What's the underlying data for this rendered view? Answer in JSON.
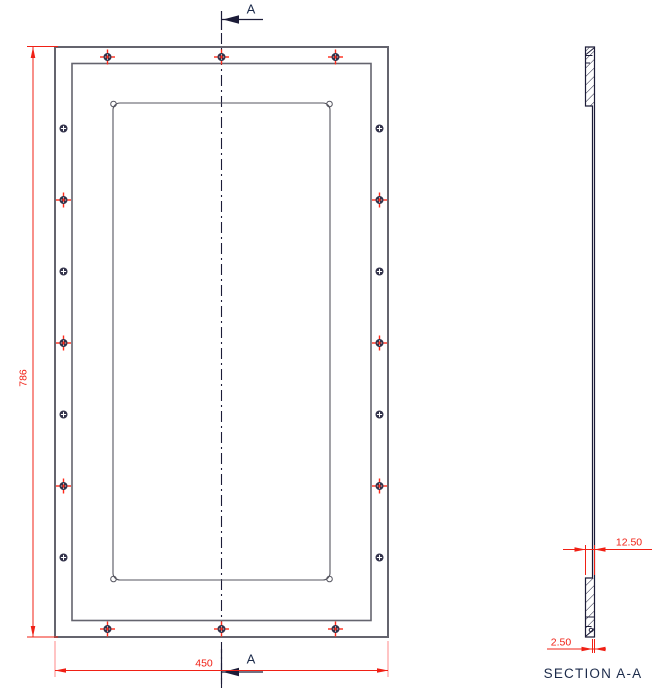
{
  "drawing": {
    "front_view": {
      "section_label_top": "A",
      "section_label_bottom": "A",
      "height_dim": "786",
      "width_dim": "450",
      "holes": [
        {
          "x": 107.5,
          "y": 57,
          "type": "cross"
        },
        {
          "x": 221.5,
          "y": 57,
          "type": "cross"
        },
        {
          "x": 335.5,
          "y": 57,
          "type": "cross"
        },
        {
          "x": 107.5,
          "y": 629,
          "type": "cross"
        },
        {
          "x": 221.5,
          "y": 629,
          "type": "cross"
        },
        {
          "x": 335.5,
          "y": 629,
          "type": "cross"
        },
        {
          "x": 63.5,
          "y": 128.5,
          "type": "plain"
        },
        {
          "x": 63.5,
          "y": 200,
          "type": "cross"
        },
        {
          "x": 63.5,
          "y": 271.5,
          "type": "plain"
        },
        {
          "x": 63.5,
          "y": 343,
          "type": "cross"
        },
        {
          "x": 63.5,
          "y": 414.5,
          "type": "plain"
        },
        {
          "x": 63.5,
          "y": 486,
          "type": "cross"
        },
        {
          "x": 63.5,
          "y": 557.5,
          "type": "plain"
        },
        {
          "x": 379.5,
          "y": 128.5,
          "type": "plain"
        },
        {
          "x": 379.5,
          "y": 200,
          "type": "cross"
        },
        {
          "x": 379.5,
          "y": 271.5,
          "type": "plain"
        },
        {
          "x": 379.5,
          "y": 343,
          "type": "cross"
        },
        {
          "x": 379.5,
          "y": 414.5,
          "type": "plain"
        },
        {
          "x": 379.5,
          "y": 486,
          "type": "cross"
        },
        {
          "x": 379.5,
          "y": 557.5,
          "type": "plain"
        }
      ]
    },
    "section_view": {
      "title": "SECTION A-A",
      "depth_dim": "12.50",
      "thickness_dim": "2.50"
    },
    "colors": {
      "dimension_red": "#f02015",
      "extension_pink": "#ff9d9d",
      "edge_gray": "#64646e",
      "line_navy": "#1c1c38",
      "hole_fill": "#32324a",
      "label_navy": "#1b2a4a",
      "centermark_red": "#ff2a1a"
    }
  }
}
